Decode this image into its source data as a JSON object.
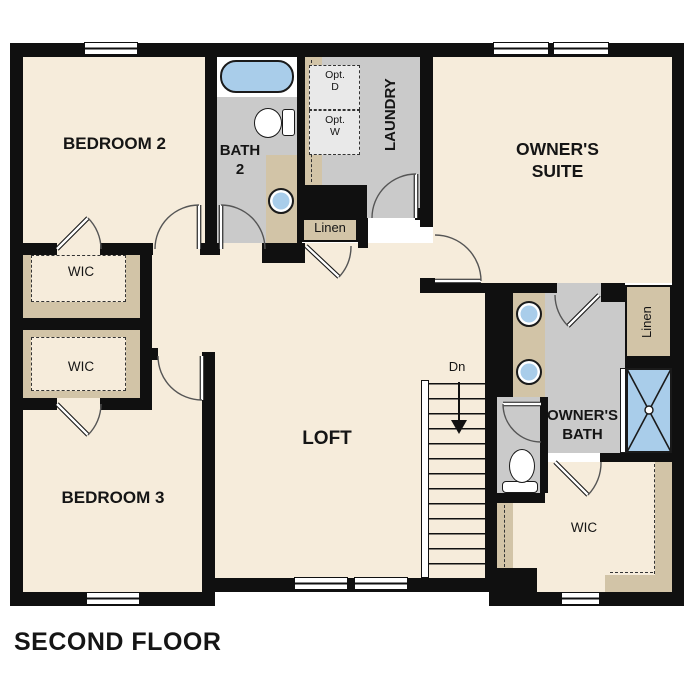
{
  "title": "SECOND FLOOR",
  "labels": {
    "bedroom2": "BEDROOM 2",
    "bedroom3": "BEDROOM 3",
    "bath2": "BATH 2",
    "laundry": "LAUNDRY",
    "owners_suite": "OWNER'S SUITE",
    "owners_bath": "OWNER'S BATH",
    "loft": "LOFT",
    "wic": "WIC",
    "linen": "Linen",
    "opt_dryer": "Opt. D",
    "opt_washer": "Opt. W",
    "stairs_down": "Dn"
  },
  "colors": {
    "wall": "#101010",
    "floor_cream": "#f6ecdb",
    "closet_tan": "#d2c4a7",
    "bath_gray": "#cacaca",
    "fixture_blue": "#a9cdea",
    "option_gray": "#e9e9e9"
  }
}
